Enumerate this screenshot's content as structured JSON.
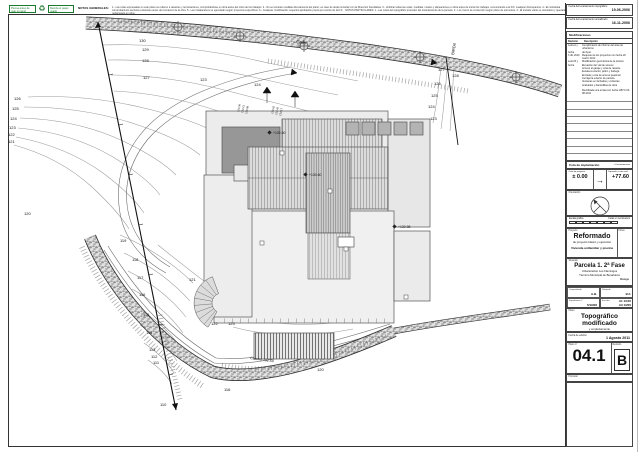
{
  "stamp": {
    "left": "Piensa antes de usar el papel",
    "right": "Recicla el papel usado",
    "icon": "♻"
  },
  "notes": {
    "title": "NOTAS GENERALES:",
    "line1": "1.- Las cotas expresadas en este plano se refieren a rasantes y terminaciones, comprobándose en obra antes del inicio de los trabajos. 2.- No se tomarán medidas directamente del plano; en caso de duda consultar con la Dirección Facultativa. 3.- Verificar todas las cotas, medidas, niveles y alineaciones en obra antes de iniciar los trabajos, comunicando a la D.F. cualquier discrepancia. 4.- El contratista comprobará los servicios existentes antes del comienzo de la obra.",
    "line2": "5.- Las instalaciones se ejecutarán según proyectos específicos. 6.- Cualquier modificación requerirá aprobación previa por escrito de la D.F. · NOTAS PARTICULARES: 1.- Las cotas del topográfico proceden del levantamiento de la parcela. 2.- Los muros de contención según plano de estructura. 3.- El trazado viario es orientativo y quedará replanteado en obra."
  },
  "titleblock": {
    "date1_label": "Fecha del levantamiento topográfico:",
    "date1_value": "19-06-2006",
    "date2_label": "Fecha del levantamiento actualizado:",
    "date2_value": "16-11-2006",
    "modifications": {
      "title": "Modificaciones",
      "col_rev": "Revisión",
      "col_desc": "Descripción",
      "rows": [
        {
          "rev": "Letra A y",
          "desc": "Cumplimiento de informe del área de urbanismo"
        },
        {
          "rev": "fecha",
          "desc": "del Ayto."
        },
        {
          "rev": "3 dic 2010",
          "desc": "Reajuste de los proyectos con fecha 20 marzo 2011:"
        },
        {
          "rev": "Letra B y",
          "desc": "Modificación geométrica de la piscina"
        },
        {
          "rev": "fecha",
          "desc": "Elevación del vial de acceso"
        },
        {
          "rev": "",
          "desc": "Acceso al garaje y cota de rasante"
        },
        {
          "rev": "",
          "desc": "Escalera exterior, jardín y bodega"
        },
        {
          "rev": "",
          "desc": "Entrada y cota de acceso peatonal"
        },
        {
          "rev": "",
          "desc": "Cerrajería exterior de parcela"
        },
        {
          "rev": "",
          "desc": "Ventanas en fachadas y cubiertas"
        },
        {
          "rev": "",
          "desc": "Acabados y barandillas de obra"
        }
      ],
      "note": "Rectificada una errata con fecha s/BTU 03-08-2011"
    },
    "cota_bar_left": "Cota de implantación",
    "cota_bar_right": "s/ levantamiento",
    "cota_left_label": "Cota de proyecto",
    "cota_left_value": "± 0.00",
    "cota_right_label": "Equivale a cota real",
    "cota_right_value": "+77.60",
    "orientacion_label": "Orientación",
    "escala_label": "Escala gráfica",
    "escala_units": "Cotas en centímetros",
    "proyecto_label": "Proyecto",
    "firma_label": "Firma",
    "proyecto_title": "Reformado",
    "proyecto_sub": "de proyecto básico y ejecución",
    "proyecto_obj": "Vivienda unifamiliar y piscina",
    "situacion_label": "Situación",
    "situacion_1": "Parcela 1. 2ª Fase",
    "situacion_2": "Urbanización Los Flamingos",
    "situacion_3": "Término Municipal de Benahavís",
    "situacion_4": "Málaga",
    "comprobado_label": "Comprobado",
    "comprobado": "A.B.",
    "dibujado_label": "Dibujado",
    "dibujado": "B.F.",
    "expediente_label": "Expediente nº",
    "expediente": "5/19/06",
    "escalas_label": "Escalas",
    "escala_a1": "A1 1/100",
    "escala_a3": "A3 1/200",
    "plano_label": "Plano",
    "plano_title1": "Topográfico",
    "plano_title2": "modificado",
    "plano_sub": "y emplazamiento",
    "fecha_label": "Fecha de edición",
    "fecha_value": "1 Agosto 2011",
    "num_label": "Plano nº",
    "num_value": "04.1",
    "rev_label": "Revisión",
    "rev_value": "B",
    "promotor_label": "Promotor"
  },
  "drawing": {
    "street": "Calle",
    "side": "BIRD4",
    "camino": "Camino 101.50",
    "upper": [
      "130",
      "129",
      "128",
      "127"
    ],
    "left": [
      "126",
      "125",
      "124",
      "123",
      "122",
      "121",
      "120"
    ],
    "lower": [
      "119",
      "118",
      "117",
      "116",
      "115",
      "114",
      "113",
      "112",
      "111",
      "110"
    ],
    "right": [
      "127",
      "126",
      "125",
      "124",
      "123",
      "128"
    ],
    "spots": [
      "123",
      "124",
      "121",
      "122",
      "123",
      "120",
      "116"
    ],
    "levels": [
      "+130.60",
      "+130.60",
      "+130.98"
    ],
    "stack1": [
      "124.36",
      "124.21",
      "124.08"
    ],
    "stack2": [
      "124.65",
      "124.42",
      "124.17"
    ]
  }
}
